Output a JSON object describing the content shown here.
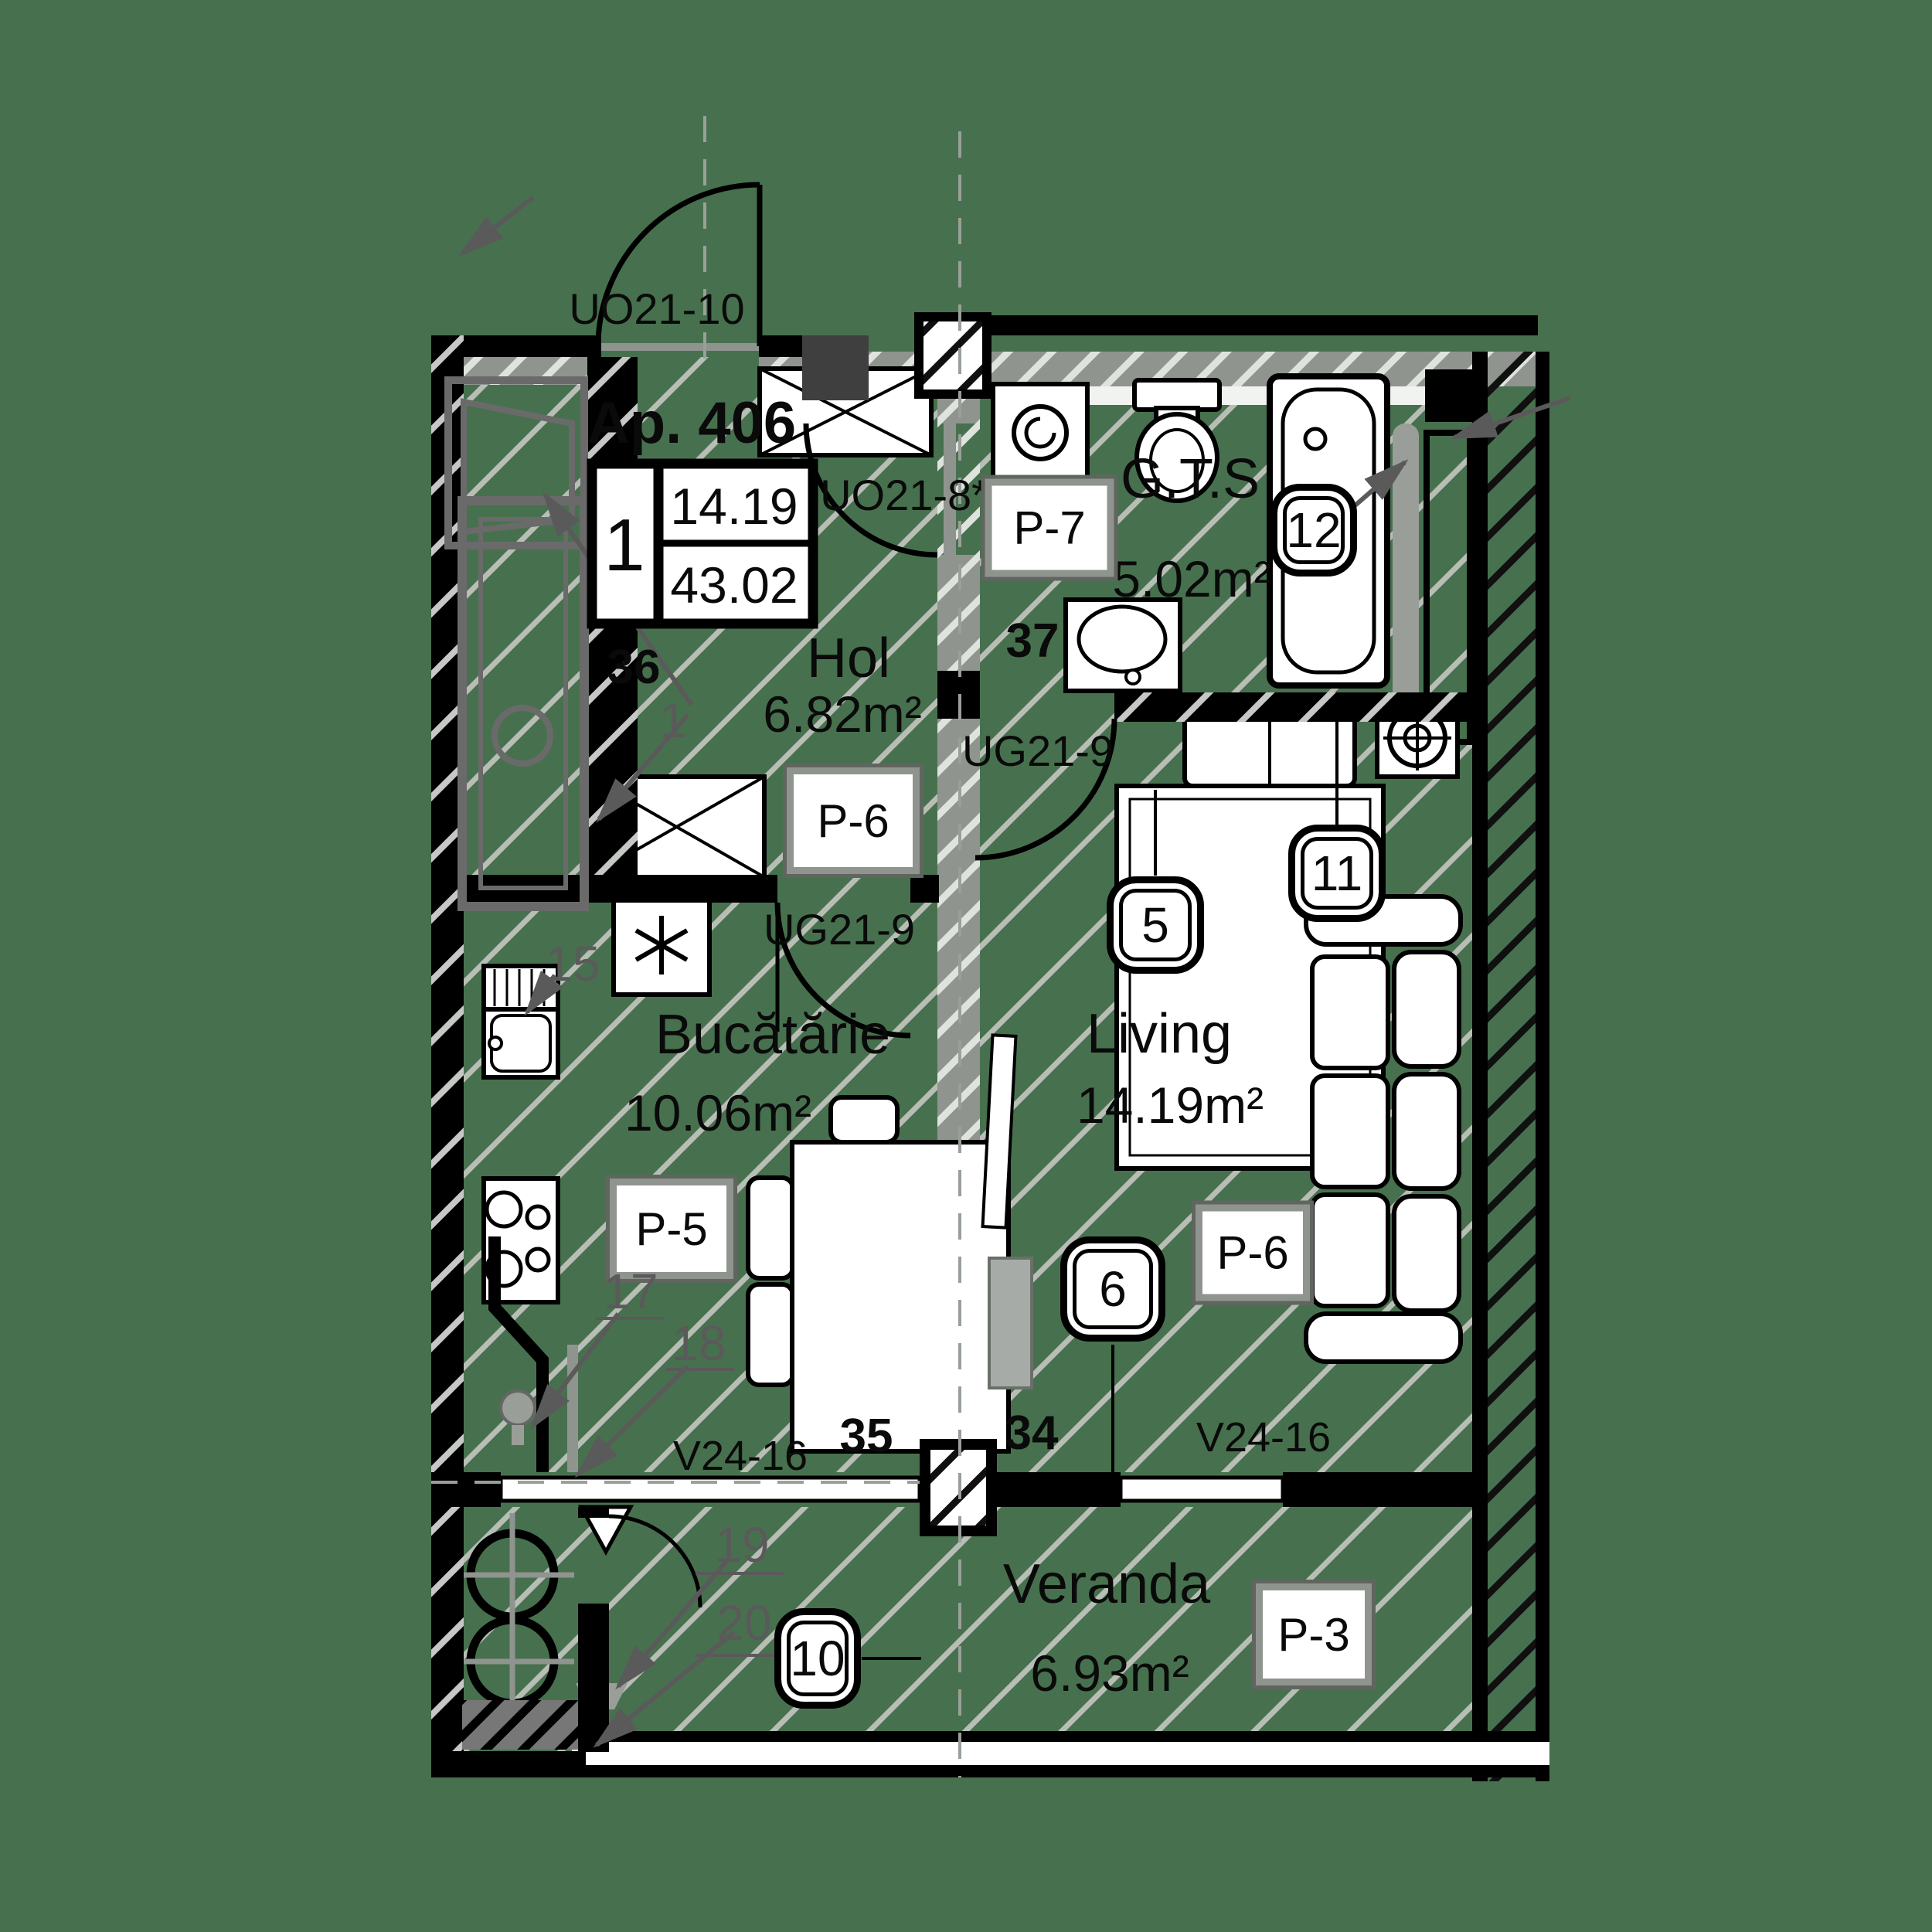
{
  "colors": {
    "background": "#47714E",
    "wall": "#000000",
    "gray_wall": "#8f948f",
    "hatch_line": "#b8beb6",
    "annotation": "#5a5a5a",
    "window_frame": "#6a6a6a"
  },
  "header": {
    "apartment": "Ap. 406"
  },
  "legend": {
    "rooms": "1",
    "living_area": "14.19",
    "total_area": "43.02"
  },
  "rooms": {
    "hol": {
      "name": "Hol",
      "area": "6.82m²",
      "finish": "P-6"
    },
    "gts": {
      "name": "G.T.S",
      "area": "5.02m²",
      "finish": "P-7"
    },
    "kitchen": {
      "name": "Bucătărie",
      "area": "10.06m²",
      "finish": "P-5"
    },
    "living": {
      "name": "Living",
      "area": "14.19m²",
      "finish": "P-6"
    },
    "veranda": {
      "name": "Veranda",
      "area": "6.93m²",
      "finish": "P-3"
    }
  },
  "openings": {
    "entry_door": "UO21-10",
    "gts_door": "UO21-8*",
    "living_door": "UG21-9",
    "kitchen_door": "UG21-9",
    "window_left": "V24-16",
    "window_right": "V24-16"
  },
  "wall_marks": {
    "n34": "34",
    "n35": "35",
    "n36": "36",
    "n37": "37"
  },
  "detail_marks": {
    "d1": "1",
    "d15": "15",
    "d17": "17",
    "d18": "18",
    "d19": "19",
    "d20": "20"
  },
  "callouts": {
    "c5": "5",
    "c6": "6",
    "c10": "10",
    "c11": "11",
    "c12": "12"
  }
}
